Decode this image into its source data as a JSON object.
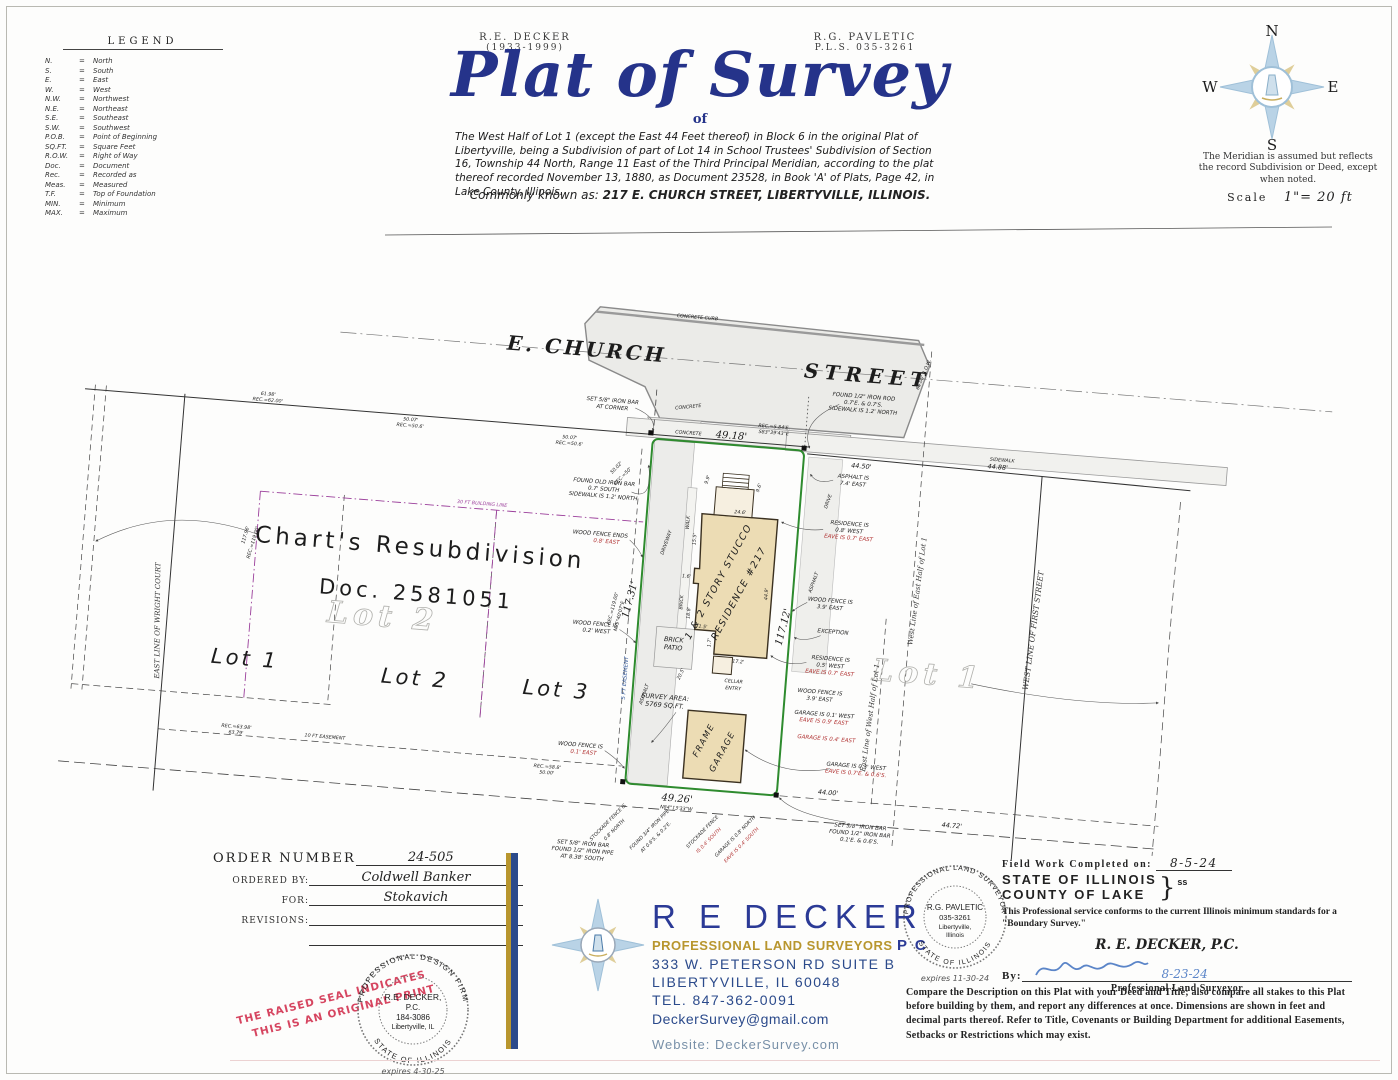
{
  "legend": {
    "title": "LEGEND",
    "eq": "=",
    "entries": [
      [
        "N.",
        "North"
      ],
      [
        "S.",
        "South"
      ],
      [
        "E.",
        "East"
      ],
      [
        "W.",
        "West"
      ],
      [
        "N.W.",
        "Northwest"
      ],
      [
        "N.E.",
        "Northeast"
      ],
      [
        "S.E.",
        "Southeast"
      ],
      [
        "S.W.",
        "Southwest"
      ],
      [
        "P.O.B.",
        "Point of Beginning"
      ],
      [
        "SQ.FT.",
        "Square Feet"
      ],
      [
        "R.O.W.",
        "Right of Way"
      ],
      [
        "Doc.",
        "Document"
      ],
      [
        "Rec.",
        "Recorded as"
      ],
      [
        "Meas.",
        "Measured"
      ],
      [
        "T.F.",
        "Top of Foundation"
      ],
      [
        "MIN.",
        "Minimum"
      ],
      [
        "MAX.",
        "Maximum"
      ]
    ]
  },
  "header": {
    "surveyor_left_name": "R.E. DECKER",
    "surveyor_left_years": "(1933-1999)",
    "surveyor_right_name": "R.G. PAVLETIC",
    "surveyor_right_license": "P.L.S. 035-3261",
    "title": "Plat of Survey",
    "of": "of",
    "legal_description": "The West Half of Lot 1 (except the East 44 Feet thereof) in Block 6 in the original Plat of Libertyville, being a Subdivision of part of Lot 14 in School Trustees' Subdivision of Section 16, Township 44 North, Range 11 East of the Third Principal Meridian, according to the plat thereof recorded November 13, 1880, as Document 23528, in Book 'A' of Plats, Page 42, in Lake County, Illinois.",
    "commonly_prefix": "Commonly known as:",
    "commonly_address": "217 E. CHURCH STREET, LIBERTYVILLE, ILLINOIS."
  },
  "compass": {
    "n": "N",
    "e": "E",
    "s": "S",
    "w": "W",
    "meridian_note": "The Meridian is assumed but reflects the record Subdivision or Deed, except when noted.",
    "scale_label": "Scale",
    "scale_value": "1\"= 20 ft"
  },
  "drawing": {
    "labels": {
      "street1": "E. CHURCH",
      "street2": "STREET",
      "concrete_curb": "CONCRETE CURB",
      "row": "66.00' R.O.W.",
      "set_bar_corner": [
        "SET 5/8\" IRON BAR",
        "AT CORNER"
      ],
      "concrete_a": "CONCRETE",
      "concrete_b": "CONCRETE",
      "rec_top": [
        "REC.=5.84'E.",
        "S83°39'43\"E"
      ],
      "dim_4918": "49.18'",
      "found_old_bar": [
        "FOUND OLD IRON BAR",
        "0.7' SOUTH",
        "SIDEWALK IS 1.2' NORTH"
      ],
      "rec_5002": [
        "50.02'",
        "REC.=50'"
      ],
      "dim_6198": [
        "61.98'",
        "REC.=62.00'"
      ],
      "dim_5007a": [
        "50.07'",
        "REC.=50.6'"
      ],
      "dim_5007b": [
        "50.07'",
        "REC.=50.6'"
      ],
      "found_rod": [
        "FOUND 1/2\" IRON ROD",
        "0.7'E. & 0.7'S.",
        "SIDEWALK IS 1.2' NORTH"
      ],
      "sidewalk": "SIDEWALK",
      "dim_4450": "44.50'",
      "asphalt_74": [
        "ASPHALT IS",
        "7.4' EAST"
      ],
      "drive": "DRIVE",
      "asphalt_r": "ASPHALT",
      "res_08": [
        "RESIDENCE IS",
        "0.8' WEST"
      ],
      "res_08_red": "EAVE IS 0.7' EAST",
      "wood_fence_ends": "WOOD FENCE ENDS",
      "wood_fence_ends_red": "0.8' EAST",
      "wood_fence_02": [
        "WOOD FENCE IS",
        "0.2' WEST"
      ],
      "wood_fence_39a": [
        "WOOD FENCE IS",
        "3.9' EAST"
      ],
      "exception": "EXCEPTION",
      "res_05": [
        "RESIDENCE IS",
        "0.5' WEST"
      ],
      "res_05_red": "EAVE IS 0.7' EAST",
      "wood_fence_39b": [
        "WOOD FENCE IS",
        "3.9' EAST"
      ],
      "garage_01": "GARAGE IS 0.1' WEST",
      "garage_01_red": "EAVE IS 0.9' EAST",
      "garage_04_red": "GARAGE IS 0.4' EAST",
      "garage_03": "GARAGE IS 0.3' WEST",
      "garage_03_red": "EAVE IS 0.7'E. & 0.6'S.",
      "set_found_br": [
        "SET 5/8\" IRON BAR",
        "FOUND 1/2\" IRON BAR",
        "0.1'E. & 0.6'S."
      ],
      "dim_4400": "44.00'",
      "dim_4488": "44.88'",
      "dim_4472": "44.72'",
      "east_line_wh": "East Line of West Half of Lot 1",
      "west_line_eh": "West Line of East Half of Lot 1",
      "first_street": "WEST LINE OF FIRST STREET",
      "lot1_ghost": "Lot 1",
      "lot2_ghost": "Lot 2",
      "charts": "Chart's  Resubdivision",
      "doc": "Doc. 2581051",
      "lot1": "Lot 1",
      "lot2": "Lot 2",
      "lot3": "Lot 3",
      "wright": "EAST LINE OF WRIGHT COURT",
      "dim_11796": [
        "117.96'",
        "REC.=119.00'"
      ],
      "bldg_line": "30 FT BUILDING LINE",
      "esmt5": "5 FT EASEMENT",
      "esmt10": "10 FT EASEMENT",
      "rec_6398": [
        "REC.=63.98'",
        "63.79'"
      ],
      "rec_588": [
        "REC.=58.8'",
        "50.00'"
      ],
      "dim_11731": "117.31'",
      "rec_119": [
        "REC.=119.00'",
        "N05°40'07\"E"
      ],
      "dim_11712": "117.12'",
      "residence": [
        "1 & 2 STORY STUCCO",
        "RESIDENCE #217"
      ],
      "d246": "24.6'",
      "d155": "15.5'",
      "d16": "1.6'",
      "d188": "18.8'",
      "d15": "1.5'",
      "d17": "1.7'",
      "d172": "17.2'",
      "d449": "44.9'",
      "d99": "9.9'",
      "d96": "9.6'",
      "d205": "20.5'",
      "brick_patio": [
        "BRICK",
        "PATIO"
      ],
      "cellar": [
        "CELLAR",
        "ENTRY"
      ],
      "survey_area": [
        "SURVEY AREA:",
        "5769 SQ.FT."
      ],
      "driveway": "DRIVEWAY",
      "asphalt_l": "ASPHALT",
      "brick": "BRICK",
      "walk": "WALK",
      "garage_label": [
        "FRAME",
        "GARAGE"
      ],
      "dim_4926": "49.26'",
      "bearing_b": "N84°13'33\"W",
      "set_found_pipe": [
        "SET 5/8\" IRON BAR",
        "FOUND 1/2\" IRON PIPE",
        "AT 8.38' SOUTH"
      ],
      "wood_fence_01": "WOOD FENCE IS",
      "wood_fence_01_red": "0.1' EAST",
      "stockade_08": [
        "STOCKADE FENCE IS",
        "0.8' NORTH"
      ],
      "found_pipe34": [
        "FOUND 3/4\" IRON PIPE",
        "AT 0.6'S. & 0.2'E."
      ],
      "stockade_04": "STOCKADE FENCE",
      "stockade_04_red": "IS 0.4' SOUTH",
      "garage_08n": "GARAGE IS 0.8' NORTH",
      "garage_08n_red": "EAVE IS 0.4' SOUTH"
    }
  },
  "order_block": {
    "order_number_label": "ORDER NUMBER",
    "order_number": "24-505",
    "ordered_by_label": "ORDERED BY:",
    "ordered_by": "Coldwell Banker",
    "for_label": "FOR:",
    "for_value": "Stokavich",
    "revisions_label": "REVISIONS:"
  },
  "stamp": {
    "line1": "THE RAISED SEAL INDICATES",
    "line2": "THIS IS AN ORIGINAL PRINT"
  },
  "design_seal": {
    "ring_top": "PROFESSIONAL DESIGN FIRM",
    "ring_bottom": "STATE OF ILLINOIS",
    "name": "R.E. DECKER,",
    "pc": "P.C.",
    "number": "184-3086",
    "city": "Libertyville, IL",
    "expires": "expires 4-30-25"
  },
  "pavletic_seal": {
    "ring_top": "PROFESSIONAL LAND SURVEYOR",
    "ring_bottom": "STATE OF ILLINOIS",
    "name": "R.G. PAVLETIC",
    "number": "035-3261",
    "city": "Libertyville,",
    "state": "Illinois",
    "expires": "expires 11-30-24"
  },
  "company": {
    "name": "R E DECKER",
    "tagline": "PROFESSIONAL LAND SURVEYORS",
    "pc": "P C",
    "address": "333 W. PETERSON RD SUITE B",
    "city": "LIBERTYVILLE, IL  60048",
    "tel": "TEL. 847-362-0091",
    "email": "DeckerSurvey@gmail.com",
    "website": "Website: DeckerSurvey.com"
  },
  "certification": {
    "field_work_label": "Field Work Completed on:",
    "field_work_date": "8-5-24",
    "state_line1": "STATE OF ILLINOIS",
    "state_line2": "COUNTY OF LAKE",
    "brace": "}",
    "ss": "ss",
    "conforms": "This Professional service conforms to the current Illinois minimum  standards for a \"Boundary Survey.\"",
    "firm": "R. E. DECKER, P.C.",
    "by_label": "By:",
    "sign_date": "8-23-24",
    "signer_title": "Professional Land Surveyor",
    "notice": "Compare the Description on this Plat with  your Deed and Title; also compare all stakes to this Plat before building by them, and report any  differences at once. Dimensions are shown in feet and decimal parts thereof. Refer to Title, Covenants or Building Department for additional Easements, Setbacks or Restrictions which may exist."
  }
}
